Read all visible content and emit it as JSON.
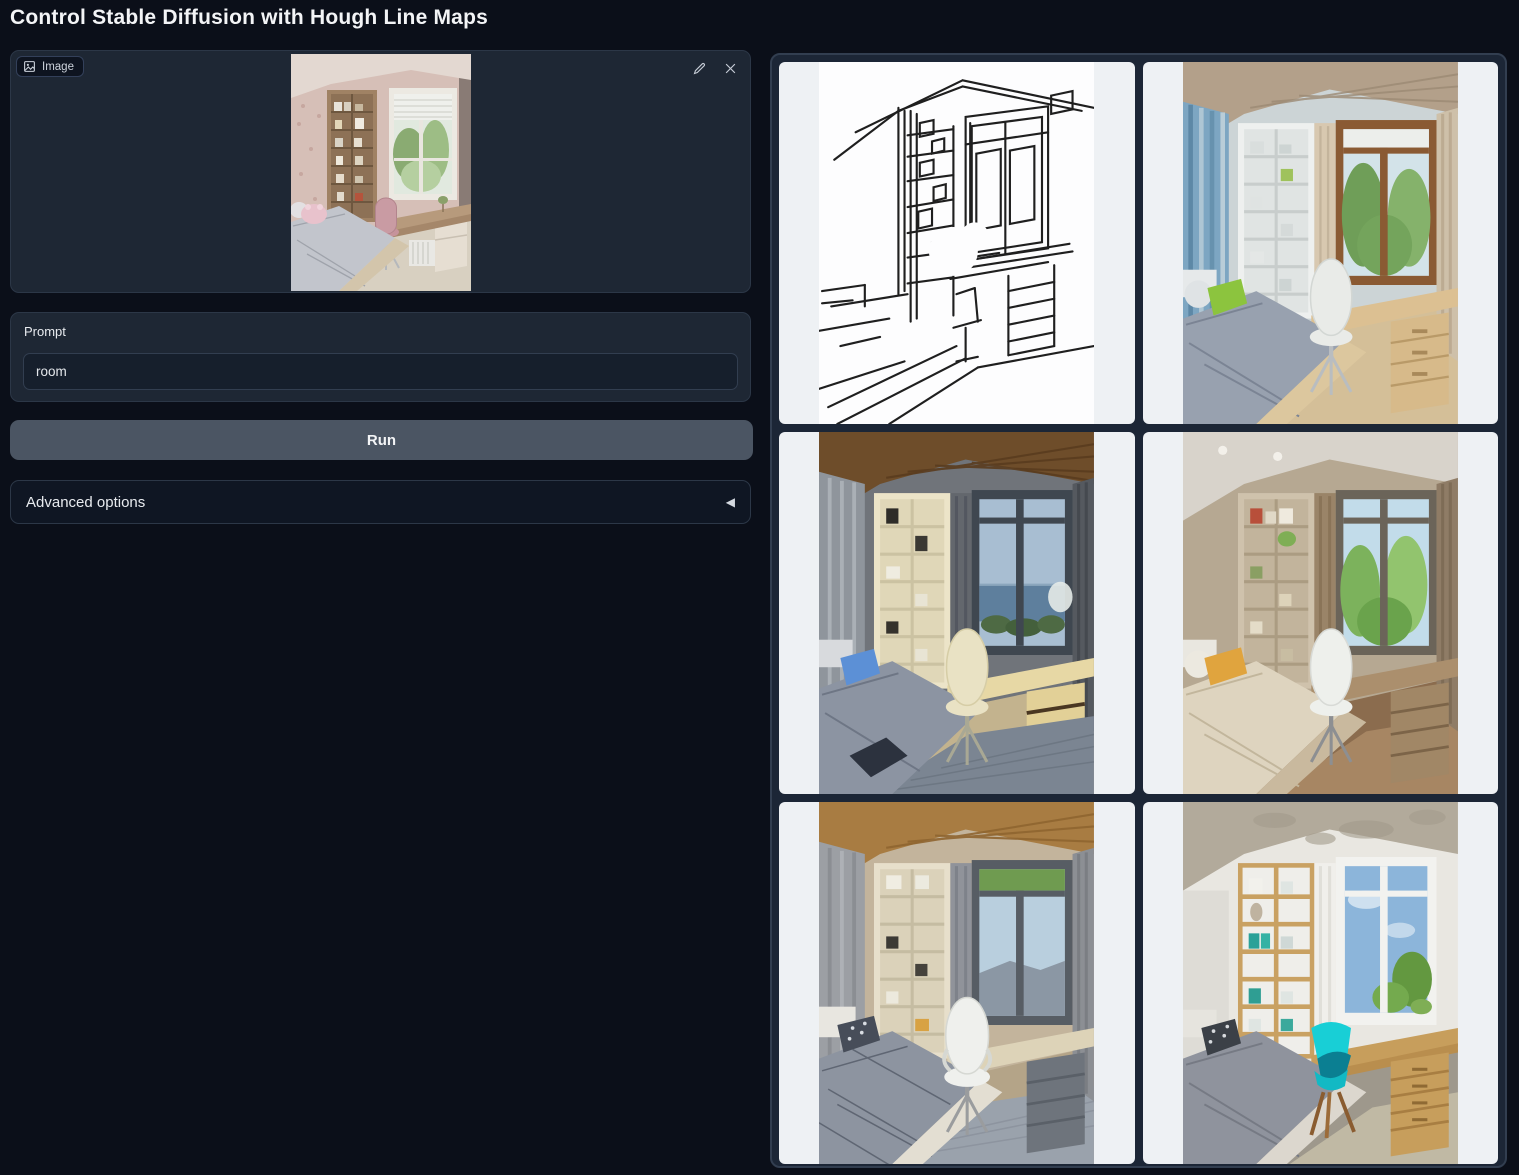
{
  "page": {
    "title": "Control Stable Diffusion with Hough Line Maps"
  },
  "colors": {
    "page_bg": "#0b0f19",
    "panel_bg": "#1e2734",
    "panel_border": "#2c3747",
    "input_bg": "#161f2c",
    "run_button_bg": "#4b5563",
    "accordion_bg": "#0f1623",
    "gallery_bg": "#1c2636",
    "gallery_border": "#323e50",
    "gallery_cell_bg": "#eef1f4",
    "text_primary": "#f3f4f6",
    "text_secondary": "#ccd2db"
  },
  "upload": {
    "label": "Image",
    "image_name": "child-bedroom-photo-with-desk-bookshelf-window-and-bed",
    "edit_icon": "pencil-icon",
    "clear_icon": "close-icon"
  },
  "prompt": {
    "label": "Prompt",
    "value": "room"
  },
  "run": {
    "label": "Run"
  },
  "advanced": {
    "label": "Advanced options",
    "collapse_icon": "◀"
  },
  "gallery": {
    "items": [
      {
        "name": "hough-line-map-sketch"
      },
      {
        "name": "generated-room-blue-curtains-green-pillow"
      },
      {
        "name": "generated-room-dark-evening-sea-view"
      },
      {
        "name": "generated-room-taupe-orange-pillow"
      },
      {
        "name": "generated-room-wood-ceiling-gray-bed"
      },
      {
        "name": "generated-room-cyan-chair"
      }
    ]
  }
}
